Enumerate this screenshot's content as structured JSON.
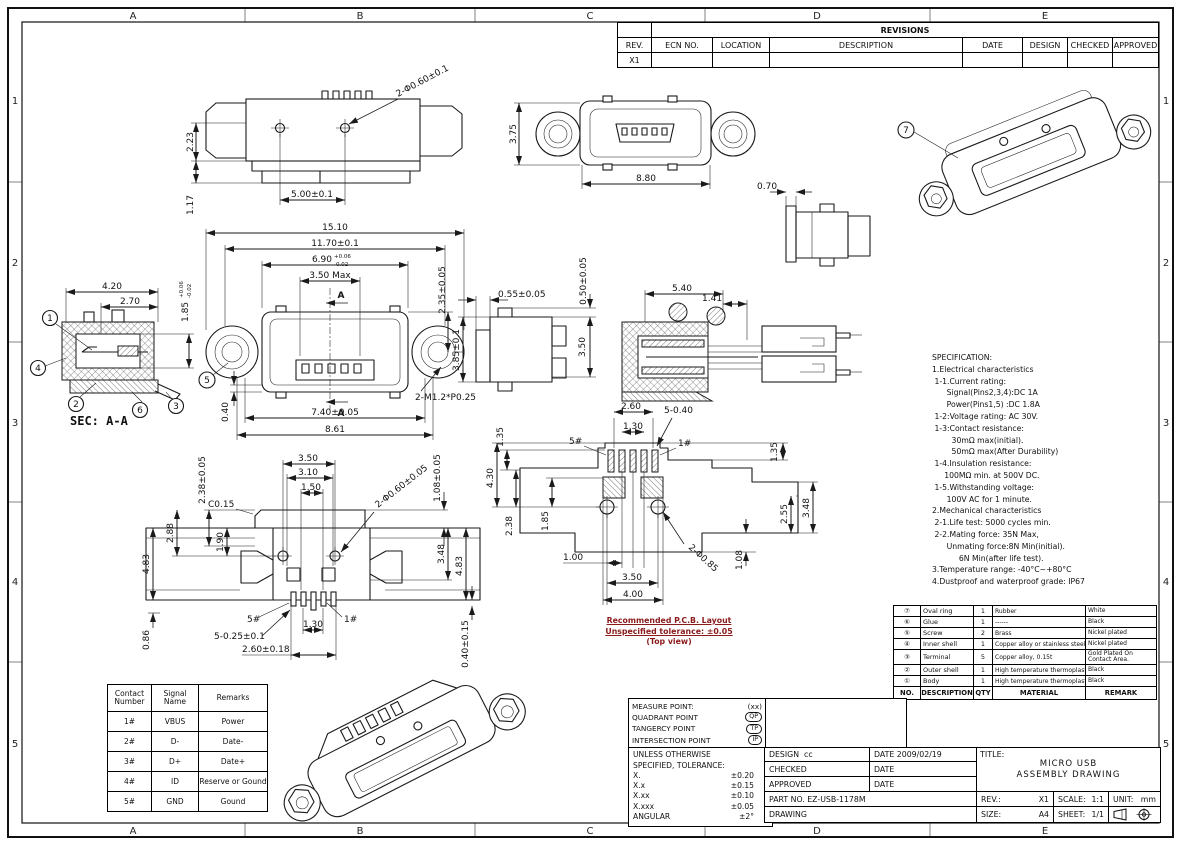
{
  "page": {
    "bg": "#ffffff",
    "line_color": "#1a1a1a",
    "accent_red": "#8b1a1a"
  },
  "border": {
    "cols": [
      "A",
      "B",
      "C",
      "D",
      "E"
    ],
    "rows": [
      "1",
      "2",
      "3",
      "4",
      "5"
    ]
  },
  "revisions": {
    "title": "REVISIONS",
    "headers": [
      "REV.",
      "ECN NO.",
      "LOCATION",
      "DESCRIPTION",
      "DATE",
      "DESIGN",
      "CHECKED",
      "APPROVED"
    ],
    "row": {
      "rev": "X1"
    }
  },
  "spec": {
    "lines": [
      "SPECIFICATION:",
      "1.Electrical characteristics",
      " 1-1.Current rating:",
      "      Signal(Pins2,3,4):DC 1A",
      "      Power(Pins1,5) :DC 1.8A",
      " 1-2:Voltage rating: AC 30V.",
      " 1-3:Contact resistance:",
      "        30mΩ max(initial).",
      "        50mΩ max(After Durability)",
      " 1-4.Insulation resistance:",
      "     100MΩ min. at 500V DC.",
      " 1-5.Withstanding voltage:",
      "      100V AC for 1 minute.",
      "2.Mechanical characteristics",
      " 2-1.Life test: 5000 cycles min.",
      " 2-2.Mating force: 35N Max,",
      "      Unmating force:8N Min(initial).",
      "           6N Min(after life test).",
      "3.Temperature range: -40°C~+80°C",
      "4.Dustproof and waterproof grade: IP67"
    ]
  },
  "bom": {
    "headers": {
      "no": "NO.",
      "desc": "DESCRIPTION",
      "qty": "QTY",
      "mat": "MATERIAL",
      "remark": "REMARK"
    },
    "rows": [
      {
        "no": "⑦",
        "desc": "Oval ring",
        "qty": "1",
        "mat": "Rubber",
        "remark": "White"
      },
      {
        "no": "⑥",
        "desc": "Glue",
        "qty": "1",
        "mat": "------",
        "remark": "Black"
      },
      {
        "no": "⑤",
        "desc": "Screw",
        "qty": "2",
        "mat": "Brass",
        "remark": "Nickel plated"
      },
      {
        "no": "④",
        "desc": "Inner shell",
        "qty": "1",
        "mat": "Copper alloy or stainless steel",
        "remark": "Nickel plated"
      },
      {
        "no": "③",
        "desc": "Terminal",
        "qty": "5",
        "mat": "Copper alloy, 0.15t",
        "remark": "Gold Plated On Contact Area."
      },
      {
        "no": "②",
        "desc": "Outer shell",
        "qty": "1",
        "mat": "High temperature thermoplastic",
        "remark": "Black"
      },
      {
        "no": "①",
        "desc": "Body",
        "qty": "1",
        "mat": "High temperature thermoplastic",
        "remark": "Black"
      }
    ]
  },
  "contacts": {
    "headers": [
      "Contact Number",
      "Signal Name",
      "Remarks"
    ],
    "rows": [
      {
        "num": "1#",
        "signal": "VBUS",
        "remark": "Power"
      },
      {
        "num": "2#",
        "signal": "D-",
        "remark": "Date-"
      },
      {
        "num": "3#",
        "signal": "D+",
        "remark": "Date+"
      },
      {
        "num": "4#",
        "signal": "ID",
        "remark": "Reserve or Gound"
      },
      {
        "num": "5#",
        "signal": "GND",
        "remark": "Gound"
      }
    ]
  },
  "legend": {
    "rows": [
      {
        "label": "MEASURE POINT:",
        "badge": "(xx)"
      },
      {
        "label": "QUADRANT POINT",
        "badge": "QP"
      },
      {
        "label": "TANGERCY POINT",
        "badge": "TP"
      },
      {
        "label": "INTERSECTION POINT",
        "badge": "IP"
      }
    ]
  },
  "tolerance": {
    "title1": "UNLESS OTHERWISE",
    "title2": "SPECIFIED, TOLERANCE:",
    "rows": [
      {
        "label": "X.",
        "value": "±0.20"
      },
      {
        "label": "X.x",
        "value": "±0.15"
      },
      {
        "label": "X.xx",
        "value": "±0.10"
      },
      {
        "label": "X.xxx",
        "value": "±0.05"
      },
      {
        "label": "ANGULAR",
        "value": "±2°"
      }
    ]
  },
  "titleblock": {
    "design_label": "DESIGN",
    "design_value": "cc",
    "date1_label": "DATE",
    "date1_value": "2009/02/19",
    "checked_label": "CHECKED",
    "date2_label": "DATE",
    "approved_label": "APPROVED",
    "date3_label": "DATE",
    "part_label": "PART NO.",
    "part_value": "EZ-USB-1178M",
    "drawing_label": "DRAWING",
    "title_label": "TITLE:",
    "title_line1": "MICRO USB",
    "title_line2": "ASSEMBLY DRAWING",
    "rev_label": "REV.:",
    "rev_value": "X1",
    "scale_label": "SCALE:",
    "scale_value": "1:1",
    "unit_label": "UNIT:",
    "unit_value": "mm",
    "size_label": "SIZE:",
    "size_value": "A4",
    "sheet_label": "SHEET:",
    "sheet_value": "1/1"
  },
  "pcb_note": {
    "line1": "Recommended P.C.B. Layout",
    "line2": "Unspecified tolerance: ±0.05",
    "line3": "(Top view)"
  },
  "views": {
    "v1": {
      "d_223": "2.23",
      "d_117": "1.17",
      "d_500": "5.00±0.1",
      "c_hole": "2-Φ0.60±0.1"
    },
    "v2": {
      "d_375": "3.75",
      "d_880": "8.80"
    },
    "v3": {
      "d_070": "0.70"
    },
    "v4": {
      "balloon": "7"
    },
    "v5": {
      "d_420": "4.20",
      "d_270": "2.70",
      "d_185": "1.85",
      "tol_p": "+0.06",
      "tol_m": "-0.02",
      "label": "SEC: A-A",
      "b1": "1",
      "b2": "2",
      "b3": "3",
      "b4": "4",
      "b6": "6"
    },
    "v6": {
      "d_1510": "15.10",
      "d_1170": "11.70±0.1",
      "d_690": "6.90",
      "tol_p": "+0.06",
      "tol_m": "-0.02",
      "d_350max": "3.50 Max",
      "d_235": "2.35±0.05",
      "d_040": "0.40",
      "d_740": "7.40±0.05",
      "d_861": "8.61",
      "c_screw": "2-M1.2*P0.25",
      "sec_a": "A",
      "b5": "5"
    },
    "v7": {
      "d_385": "3.85±0.1",
      "d_055": "0.55±0.05",
      "d_050": "0.50±0.05",
      "d_350": "3.50"
    },
    "v8": {
      "d_540": "5.40",
      "d_141": "1.41"
    },
    "v9": {
      "d_350": "3.50",
      "d_310": "3.10",
      "d_150": "1.50",
      "d_238": "2.38±0.05",
      "c_c015": "C0.15",
      "d_190": "1.90",
      "d_288": "2.88",
      "d_483l": "4.83",
      "d_086": "0.86",
      "pin5": "5#",
      "d_130": "1.30",
      "pin1": "1#",
      "d_525": "5-0.25±0.1",
      "d_260": "2.60±0.18",
      "c_hole": "2-Φ0.60±0.05",
      "d_108": "1.08±0.05",
      "d_348": "3.48",
      "d_483r": "4.83",
      "d_040": "0.40±0.15"
    },
    "v10": {
      "d_260": "2.60",
      "d_540": "5-0.40",
      "d_130": "1.30",
      "pin5": "5#",
      "pin1": "1#",
      "d_135l": "1.35",
      "d_430": "4.30",
      "d_238": "2.38",
      "d_185": "1.85",
      "d_100": "1.00",
      "d_350": "3.50",
      "d_400": "4.00",
      "c_hole": "2-Φ0.85",
      "d_108": "1.08",
      "d_255": "2.55",
      "d_348": "3.48",
      "d_135r": "1.35"
    }
  }
}
